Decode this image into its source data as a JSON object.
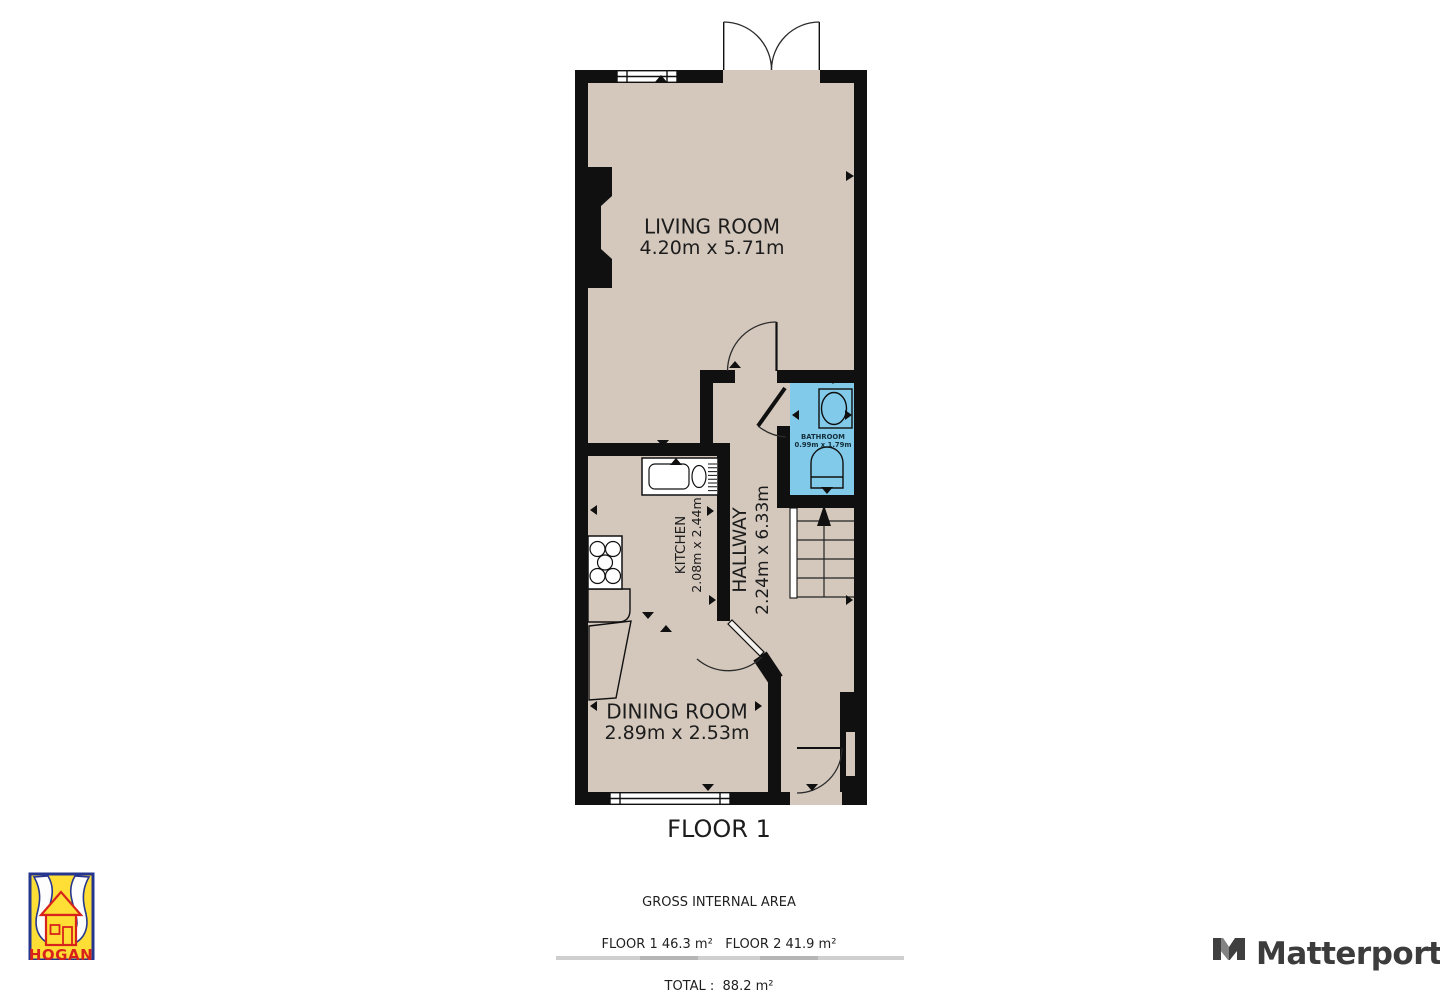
{
  "plan": {
    "floor_title": "FLOOR 1",
    "rooms": {
      "living": {
        "name": "LIVING ROOM",
        "dims": "4.20m x 5.71m"
      },
      "kitchen": {
        "name": "KITCHEN",
        "dims": "2.08m x 2.44m"
      },
      "hallway": {
        "name": "HALLWAY",
        "dims": "2.24m x 6.33m"
      },
      "bathroom": {
        "name": "BATHROOM",
        "dims": "0.99m x 1.79m"
      },
      "dining": {
        "name": "DINING ROOM",
        "dims": "2.89m x 2.53m"
      }
    }
  },
  "summary": {
    "title": "GROSS INTERNAL AREA",
    "floors_line": "FLOOR 1 46.3 m²   FLOOR 2 41.9 m²",
    "total_line": "TOTAL :  88.2 m²"
  },
  "branding": {
    "agency": "HOGAN",
    "provider": "Matterport"
  },
  "colors": {
    "floor": "#d4c8bd",
    "wall": "#101010",
    "bathroom": "#82cae9",
    "hogan_yellow": "#ffdf35",
    "hogan_blue": "#26368f",
    "hogan_red": "#d8231d"
  }
}
